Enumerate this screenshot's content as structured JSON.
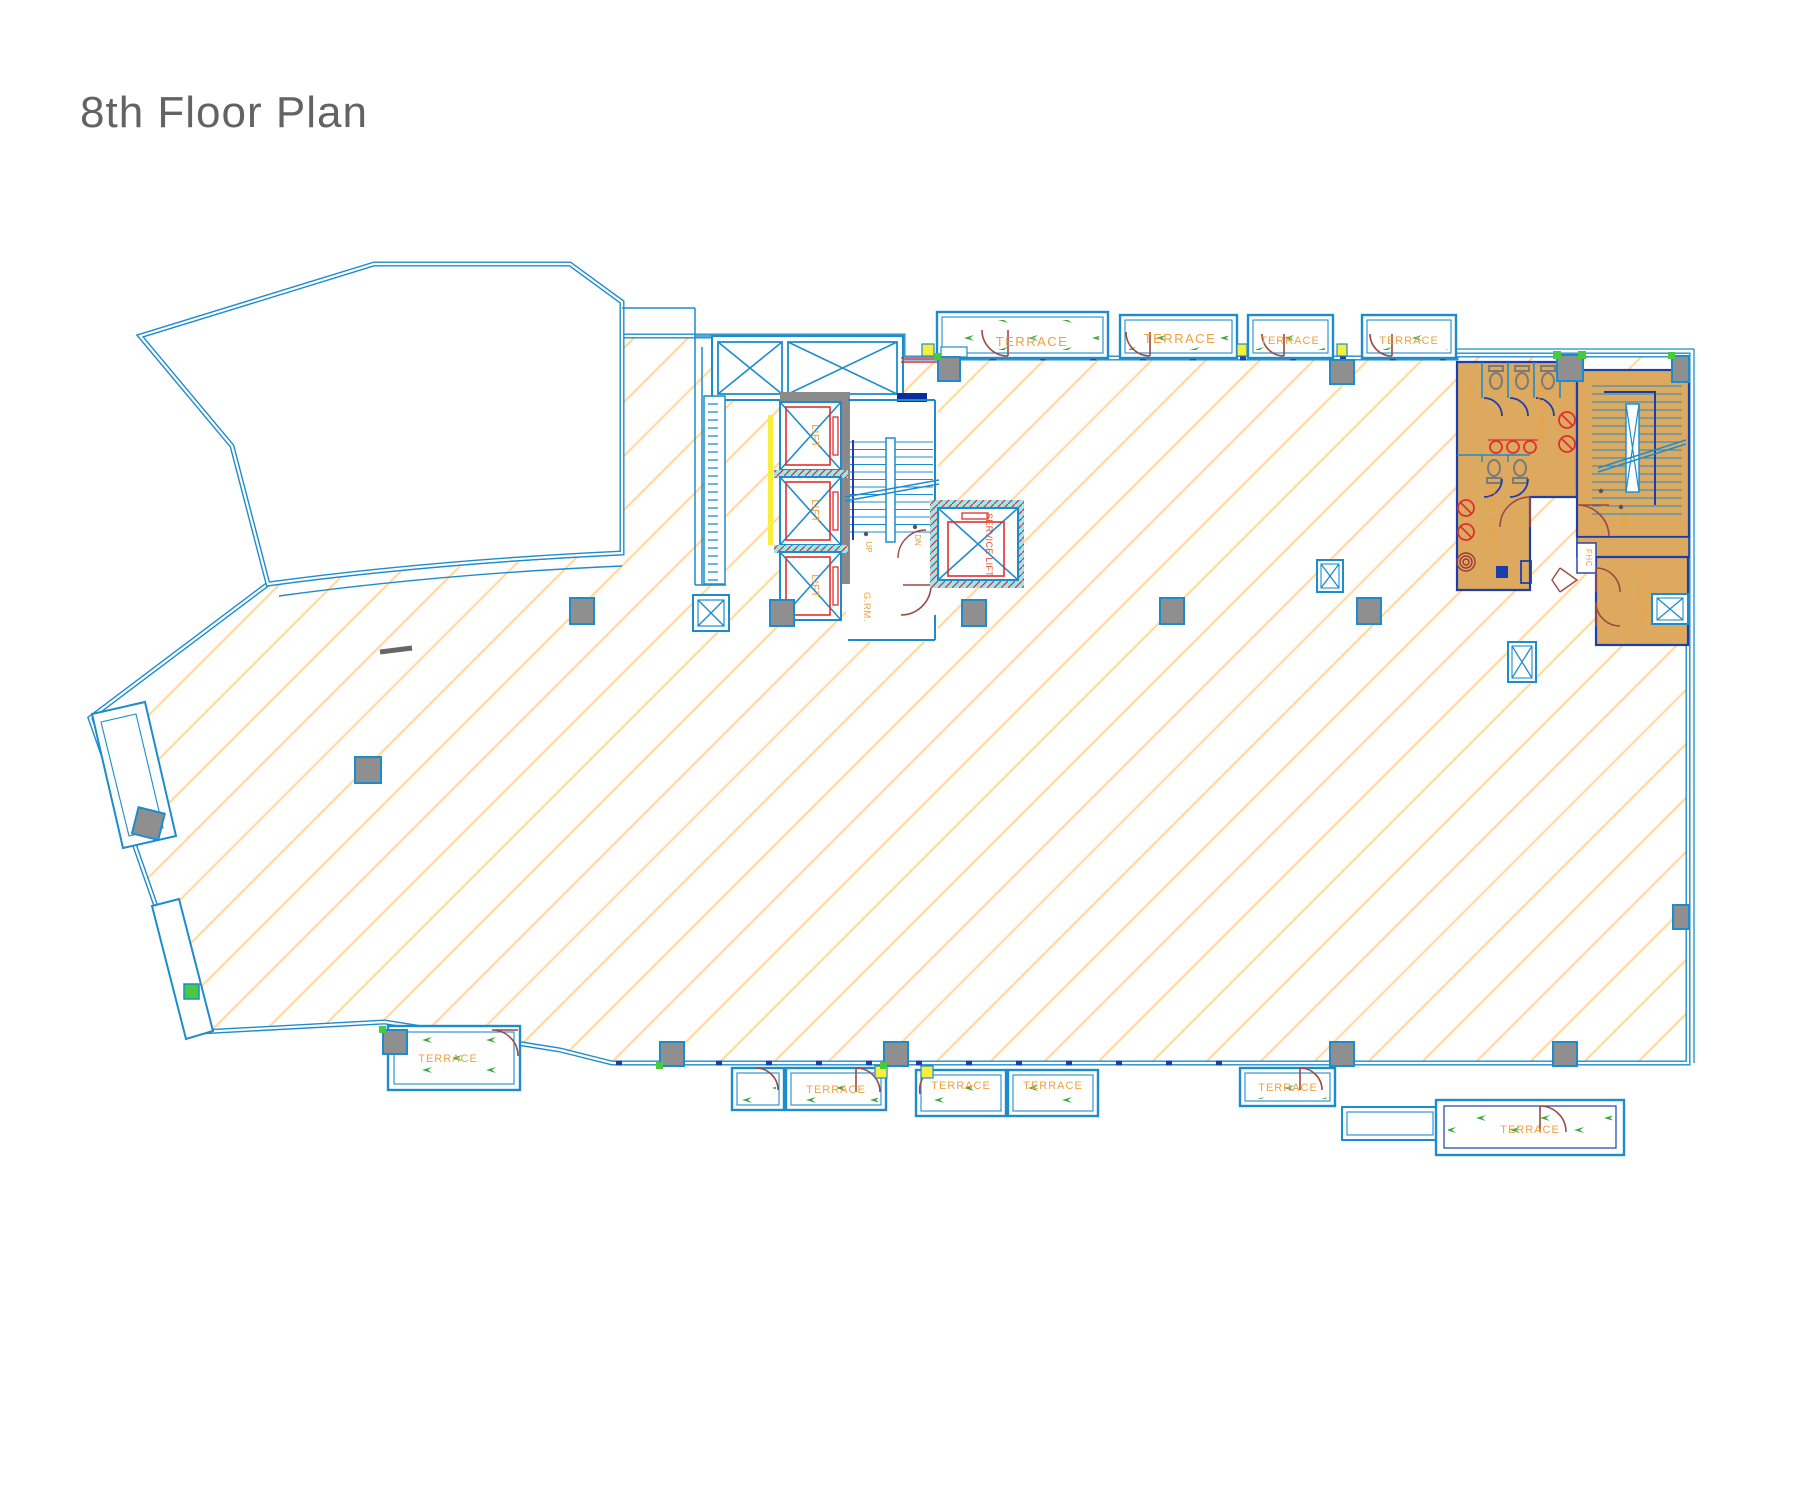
{
  "title": "8th Floor Plan",
  "plan": {
    "labels": {
      "terrace": "TERRACE",
      "lift": "LIFT",
      "service_lift": "SERVICE LIFT",
      "garbage_room": "G.RM.",
      "up": "UP",
      "dn": "DN",
      "male_toilet": "MALE TOILET",
      "female_toilet": "FEMALE TOILET",
      "janitor_closet": "J.C.",
      "fire_hose_cabinet": "FHC",
      "electrical_room": "ELEC. RM."
    },
    "colors": {
      "wall_blue": "#1d8ccd",
      "dark_blue": "#1b3faa",
      "navy": "#0a2d9c",
      "red": "#e03030",
      "door_maroon": "#9a4a42",
      "label_orange": "#f0a03c",
      "room_tan": "#dca95f",
      "hatch_orange": "#ffd9a3",
      "column_gray": "#8f8f8f",
      "core_wall_gray": "#8a8a8a",
      "accent_green": "#3aa83e",
      "accent_yellow": "#f8ef3a",
      "accent_cyan": "#9ae9ef",
      "title_gray": "#636363"
    }
  }
}
